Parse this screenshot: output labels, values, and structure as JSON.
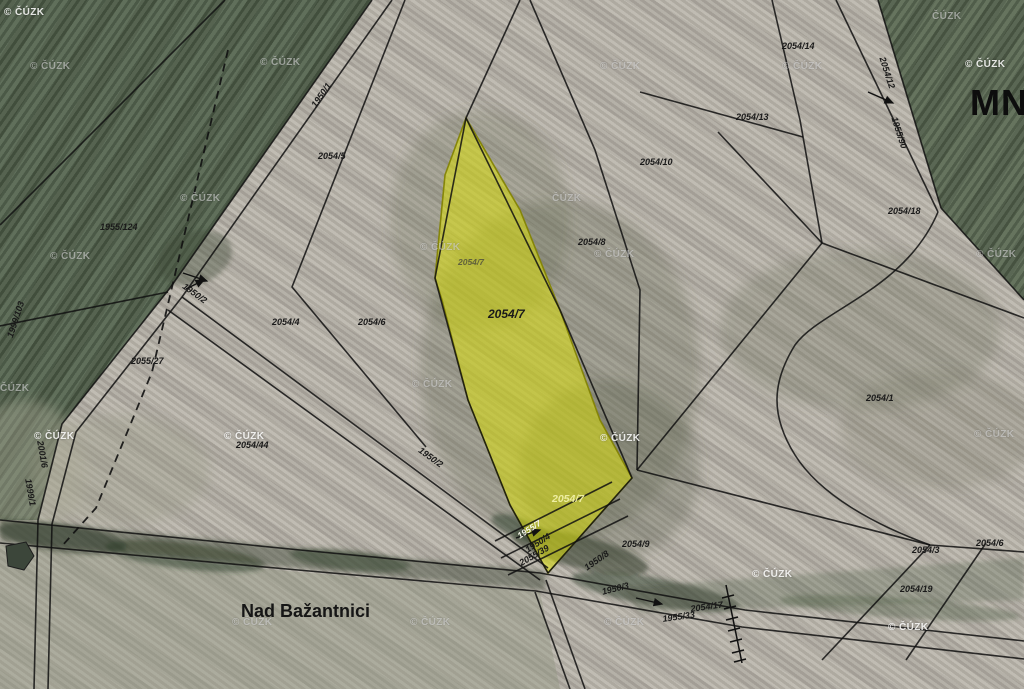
{
  "map": {
    "title_fragment": "MNÍ",
    "place_name": "Nad Bažantnici",
    "watermark_default": "© ČÚZK",
    "highlighted_parcel": {
      "number": "2054/7",
      "fill": "#e6e800",
      "border": "#8f9000"
    },
    "colors": {
      "field_light": "#b6b1a7",
      "field_green_dark": "#51614b",
      "field_green_right": "#57664f",
      "boundary_line": "#111111",
      "label_text": "#1a1a1a",
      "highlight_yellow": "#e6e800"
    },
    "parcel_labels": [
      {
        "text": "1955/124",
        "x": 100,
        "y": 223,
        "rot": 0,
        "variant": ""
      },
      {
        "text": "2055/27",
        "x": 131,
        "y": 357,
        "rot": 0,
        "variant": ""
      },
      {
        "text": "1999/103",
        "x": 6,
        "y": 336,
        "rot": -72,
        "variant": ""
      },
      {
        "text": "1950/1",
        "x": 310,
        "y": 104,
        "rot": -55,
        "variant": ""
      },
      {
        "text": "2054/5",
        "x": 318,
        "y": 152,
        "rot": 0,
        "variant": ""
      },
      {
        "text": "2054/4",
        "x": 272,
        "y": 318,
        "rot": 0,
        "variant": ""
      },
      {
        "text": "2054/6",
        "x": 358,
        "y": 318,
        "rot": 0,
        "variant": ""
      },
      {
        "text": "2054/7",
        "x": 458,
        "y": 258,
        "rot": 0,
        "variant": "dim"
      },
      {
        "text": "2054/7",
        "x": 488,
        "y": 308,
        "rot": 0,
        "variant": "big"
      },
      {
        "text": "2054/7",
        "x": 552,
        "y": 494,
        "rot": 0,
        "variant": "pale"
      },
      {
        "text": "2054/8",
        "x": 578,
        "y": 238,
        "rot": 0,
        "variant": ""
      },
      {
        "text": "2054/10",
        "x": 640,
        "y": 158,
        "rot": 0,
        "variant": ""
      },
      {
        "text": "2054/13",
        "x": 736,
        "y": 113,
        "rot": 0,
        "variant": ""
      },
      {
        "text": "2054/14",
        "x": 782,
        "y": 42,
        "rot": 0,
        "variant": ""
      },
      {
        "text": "2054/12",
        "x": 886,
        "y": 56,
        "rot": 72,
        "variant": ""
      },
      {
        "text": "1955/90",
        "x": 898,
        "y": 116,
        "rot": 72,
        "variant": ""
      },
      {
        "text": "2054/18",
        "x": 888,
        "y": 207,
        "rot": 0,
        "variant": ""
      },
      {
        "text": "2054/1",
        "x": 866,
        "y": 394,
        "rot": 0,
        "variant": ""
      },
      {
        "text": "2054/9",
        "x": 622,
        "y": 540,
        "rot": 0,
        "variant": ""
      },
      {
        "text": "2054/3",
        "x": 912,
        "y": 546,
        "rot": 0,
        "variant": ""
      },
      {
        "text": "2054/6",
        "x": 976,
        "y": 539,
        "rot": 0,
        "variant": ""
      },
      {
        "text": "2054/19",
        "x": 900,
        "y": 585,
        "rot": 0,
        "variant": ""
      },
      {
        "text": "2054/17",
        "x": 690,
        "y": 605,
        "rot": -8,
        "variant": ""
      },
      {
        "text": "1955/33",
        "x": 662,
        "y": 615,
        "rot": -8,
        "variant": ""
      },
      {
        "text": "1950/8",
        "x": 583,
        "y": 565,
        "rot": -35,
        "variant": ""
      },
      {
        "text": "1950/3",
        "x": 601,
        "y": 588,
        "rot": -14,
        "variant": ""
      },
      {
        "text": "1955/7",
        "x": 516,
        "y": 533,
        "rot": -33,
        "variant": "white"
      },
      {
        "text": "1950/4",
        "x": 524,
        "y": 547,
        "rot": -33,
        "variant": ""
      },
      {
        "text": "2055/39",
        "x": 518,
        "y": 560,
        "rot": -30,
        "variant": ""
      },
      {
        "text": "2054/44",
        "x": 236,
        "y": 441,
        "rot": 0,
        "variant": ""
      },
      {
        "text": "1950/2",
        "x": 186,
        "y": 282,
        "rot": 36,
        "variant": ""
      },
      {
        "text": "1950/2",
        "x": 422,
        "y": 446,
        "rot": 36,
        "variant": ""
      },
      {
        "text": "2001/6",
        "x": 44,
        "y": 440,
        "rot": 80,
        "variant": ""
      },
      {
        "text": "1999/1",
        "x": 32,
        "y": 478,
        "rot": 80,
        "variant": ""
      }
    ],
    "watermarks": [
      {
        "text": "© ČÚZK",
        "x": 4,
        "y": 8,
        "variant": "light"
      },
      {
        "text": "© ČÚZK",
        "x": 30,
        "y": 62,
        "variant": "gray"
      },
      {
        "text": "© ČÚZK",
        "x": 260,
        "y": 58,
        "variant": "gray"
      },
      {
        "text": "© ČÚZK",
        "x": 600,
        "y": 62,
        "variant": "gray"
      },
      {
        "text": "© ČÚZK",
        "x": 782,
        "y": 62,
        "variant": "gray"
      },
      {
        "text": "ČÚZK",
        "x": 932,
        "y": 12,
        "variant": "gray"
      },
      {
        "text": "© ČÚZK",
        "x": 965,
        "y": 60,
        "variant": "light"
      },
      {
        "text": "© ČÚZK",
        "x": 180,
        "y": 194,
        "variant": "gray"
      },
      {
        "text": "ČÚZK",
        "x": 552,
        "y": 194,
        "variant": "gray"
      },
      {
        "text": "© ČÚZK",
        "x": 50,
        "y": 252,
        "variant": "gray"
      },
      {
        "text": "© ČÚZK",
        "x": 420,
        "y": 243,
        "variant": "gray"
      },
      {
        "text": "© ČÚZK",
        "x": 594,
        "y": 250,
        "variant": "gray"
      },
      {
        "text": "© ČÚZK",
        "x": 976,
        "y": 250,
        "variant": "gray"
      },
      {
        "text": "ČÚZK",
        "x": 0,
        "y": 384,
        "variant": "gray"
      },
      {
        "text": "© ČÚZK",
        "x": 412,
        "y": 380,
        "variant": "gray"
      },
      {
        "text": "© ČÚZK",
        "x": 34,
        "y": 432,
        "variant": "light"
      },
      {
        "text": "© ČÚZK",
        "x": 224,
        "y": 432,
        "variant": "light"
      },
      {
        "text": "© ČÚZK",
        "x": 600,
        "y": 434,
        "variant": "light"
      },
      {
        "text": "© ČÚZK",
        "x": 974,
        "y": 430,
        "variant": "gray"
      },
      {
        "text": "© ČÚZK",
        "x": 752,
        "y": 570,
        "variant": "light"
      },
      {
        "text": "© ČÚZK",
        "x": 232,
        "y": 618,
        "variant": "gray"
      },
      {
        "text": "© ČÚZK",
        "x": 410,
        "y": 618,
        "variant": "gray"
      },
      {
        "text": "© ČÚZK",
        "x": 604,
        "y": 618,
        "variant": "gray"
      },
      {
        "text": "© ČÚZK",
        "x": 888,
        "y": 623,
        "variant": "light"
      }
    ],
    "arrows": [
      {
        "x1": 183,
        "y1": 273,
        "x2": 207,
        "y2": 281
      },
      {
        "x1": 868,
        "y1": 92,
        "x2": 893,
        "y2": 103
      },
      {
        "x1": 636,
        "y1": 598,
        "x2": 662,
        "y2": 604
      },
      {
        "x1": 516,
        "y1": 538,
        "x2": 540,
        "y2": 530
      },
      {
        "x1": 186,
        "y1": 289,
        "x2": 204,
        "y2": 280
      }
    ]
  }
}
